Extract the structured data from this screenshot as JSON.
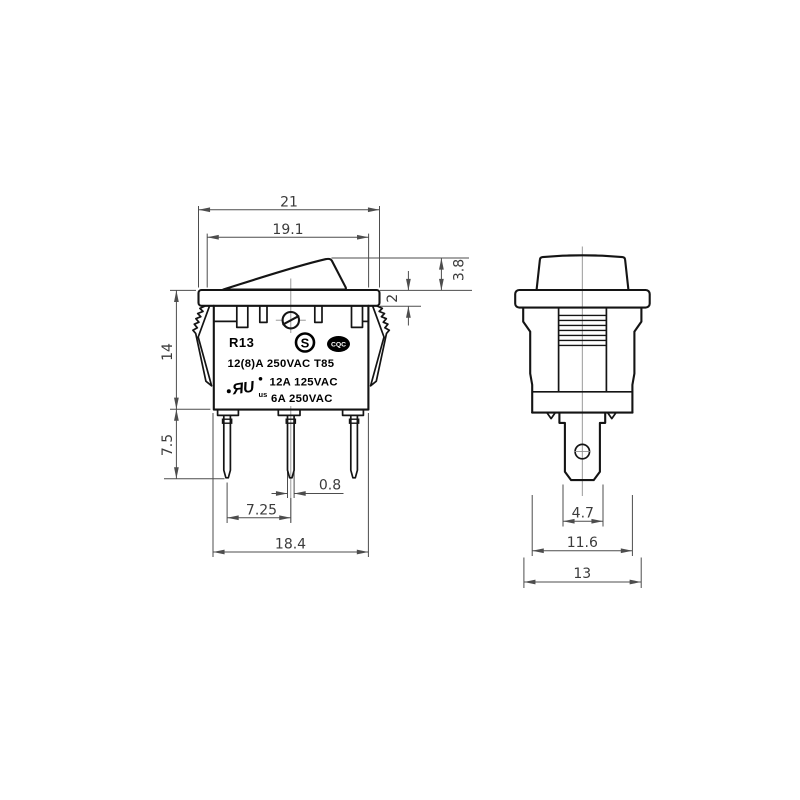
{
  "page": {
    "background": "#ffffff"
  },
  "drawing": {
    "subject": "R13 rocker switch two-view dimensioned drawing",
    "colors": {
      "object_line": "#141414",
      "dimension_line": "#4d4d4d",
      "centerline": "#8f8f8f",
      "dim_text": "#3b3b3b"
    },
    "front_view": {
      "markings": {
        "model": "R13",
        "s_mark_letter": "S",
        "cqc_mark_text": "CQC",
        "rating_line_1": "12(8)A 250VAC T85",
        "rating_line_2": "12A 125VAC",
        "rating_line_3": "6A 250VAC",
        "ul_mark_text": "ЯU",
        "ul_mark_suffix": "us"
      },
      "dimensions": {
        "flange_length": "21",
        "rocker_length": "19.1",
        "rocker_height": "3.8",
        "flange_thickness": "2",
        "body_height": "14",
        "terminal_length": "7.5",
        "terminal_thickness": "0.8",
        "terminal_pitch": "7.25",
        "body_length": "18.4"
      }
    },
    "side_view": {
      "dimensions": {
        "terminal_width": "4.7",
        "body_width": "11.6",
        "mounting_width": "13"
      }
    }
  }
}
